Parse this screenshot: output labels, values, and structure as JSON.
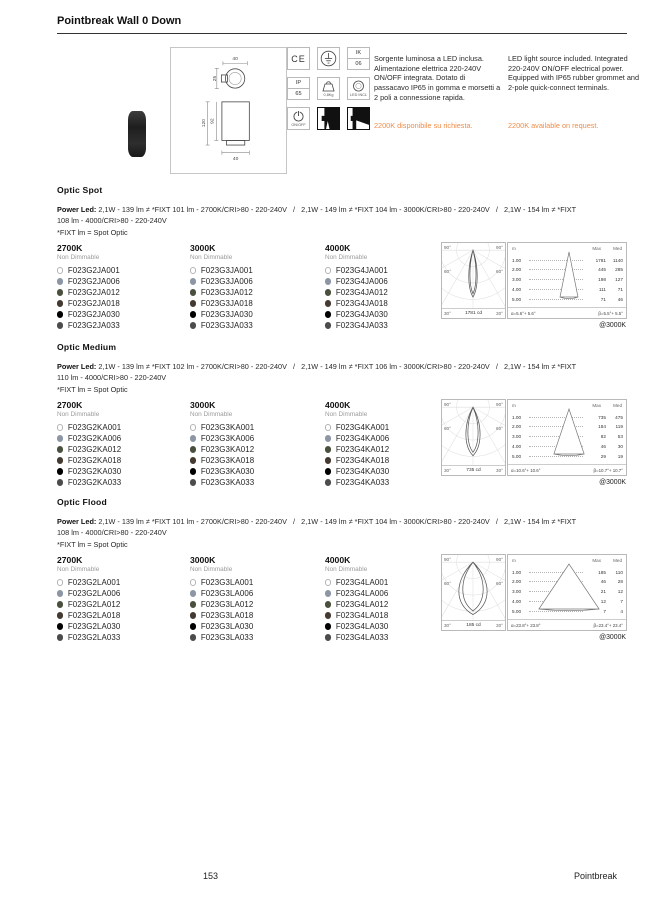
{
  "page": {
    "title": "Pointbreak Wall 0 Down",
    "page_number": "153",
    "brand": "Pointbreak"
  },
  "info": {
    "accent_color": "#ef8c48",
    "drawing": {
      "top_width": "40",
      "head_height": "25",
      "total_height": "120",
      "body_height": "92",
      "bottom_width": "40"
    },
    "icons": [
      {
        "id": "ce-mark",
        "text": "CE"
      },
      {
        "id": "class-1-earth"
      },
      {
        "id": "ik-rating",
        "top": "IK",
        "bottom": "06"
      },
      {
        "id": "ip-rating",
        "top": "IP",
        "bottom": "65"
      },
      {
        "id": "weight",
        "caption": "0,8Kg"
      },
      {
        "id": "led-included",
        "caption": "LED INCL"
      },
      {
        "id": "on-off",
        "caption": "ON/OFF"
      },
      {
        "id": "emission-down-spot"
      },
      {
        "id": "emission-down-flood"
      }
    ],
    "text_it": "Sorgente luminosa a LED inclusa. Alimentazione elettrica 220-240V ON/OFF integrata. Dotato di passacavo IP65 in gomma e morsetti a 2 poli a connessione rapida.",
    "note_it": "2200K disponibile su richiesta.",
    "text_en": "LED light source included. Integrated 220-240V ON/OFF electrical power. Equipped with IP65 rubber grommet and 2-pole quick-connect terminals.",
    "note_en": "2200K available on request."
  },
  "labels": {
    "m": "m",
    "max": "Max",
    "med": "Med",
    "deg90": "90°",
    "deg60": "60°",
    "deg30": "30°"
  },
  "finishes": [
    {
      "color": "#ffffff",
      "border": "#b3b3b3"
    },
    {
      "color": "#8d96a4"
    },
    {
      "color": "#49513e"
    },
    {
      "color": "#453a31"
    },
    {
      "color": "#000000"
    },
    {
      "color": "#4c4c4c"
    }
  ],
  "sections": [
    {
      "title": "Optic Spot",
      "power_led_label": "Power Led:",
      "spec": " 2,1W - 139 lm ≠ *FIXT 101 lm - 2700K/CRI>80 - 220-240V   /   2,1W - 149 lm ≠ *FIXT 104 lm - 3000K/CRI>80 - 220-240V   /   2,1W - 154 lm ≠ *FIXT 108 lm - 4000/CRI>80 - 220-240V",
      "spec_note": "*FIXT lm = Spot Optic",
      "columns": [
        {
          "temp": "2700K",
          "dimming": "Non Dimmable",
          "items": [
            "F023G2JA001",
            "F023G2JA006",
            "F023G2JA012",
            "F023G2JA018",
            "F023G2JA030",
            "F023G2JA033"
          ]
        },
        {
          "temp": "3000K",
          "dimming": "Non Dimmable",
          "items": [
            "F023G3JA001",
            "F023G3JA006",
            "F023G3JA012",
            "F023G3JA018",
            "F023G3JA030",
            "F023G3JA033"
          ]
        },
        {
          "temp": "4000K",
          "dimming": "Non Dimmable",
          "items": [
            "F023G4JA001",
            "F023G4JA006",
            "F023G4JA012",
            "F023G4JA018",
            "F023G4JA030",
            "F023G4JA033"
          ]
        }
      ],
      "photometry": {
        "polar_cd": "1781 cd",
        "beam": 5.5,
        "rows": [
          {
            "m": "1.00",
            "max": "1781",
            "med": "1140"
          },
          {
            "m": "2.00",
            "max": "445",
            "med": "285"
          },
          {
            "m": "3.00",
            "max": "198",
            "med": "127"
          },
          {
            "m": "4.00",
            "max": "111",
            "med": "71"
          },
          {
            "m": "5.00",
            "max": "71",
            "med": "46"
          }
        ],
        "alpha": "α=5.6°+ 5.6°",
        "beta": "β=5.5°+ 5.5°",
        "at_temp": "@3000K"
      }
    },
    {
      "title": "Optic Medium",
      "power_led_label": "Power Led:",
      "spec": " 2,1W - 139 lm ≠ *FIXT 102 lm - 2700K/CRI>80 - 220-240V   /   2,1W - 149 lm ≠ *FIXT 106 lm - 3000K/CRI>80 - 220-240V   /   2,1W - 154 lm ≠ *FIXT 110 lm - 4000/CRI>80 - 220-240V",
      "spec_note": "*FIXT lm = Spot Optic",
      "columns": [
        {
          "temp": "2700K",
          "dimming": "Non Dimmable",
          "items": [
            "F023G2KA001",
            "F023G2KA006",
            "F023G2KA012",
            "F023G2KA018",
            "F023G2KA030",
            "F023G2KA033"
          ]
        },
        {
          "temp": "3000K",
          "dimming": "Non Dimmable",
          "items": [
            "F023G3KA001",
            "F023G3KA006",
            "F023G3KA012",
            "F023G3KA018",
            "F023G3KA030",
            "F023G3KA033"
          ]
        },
        {
          "temp": "4000K",
          "dimming": "Non Dimmable",
          "items": [
            "F023G4KA001",
            "F023G4KA006",
            "F023G4KA012",
            "F023G4KA018",
            "F023G4KA030",
            "F023G4KA033"
          ]
        }
      ],
      "photometry": {
        "polar_cd": "735 cd",
        "beam": 10.7,
        "rows": [
          {
            "m": "1.00",
            "max": "735",
            "med": "475"
          },
          {
            "m": "2.00",
            "max": "184",
            "med": "119"
          },
          {
            "m": "3.00",
            "max": "82",
            "med": "53"
          },
          {
            "m": "4.00",
            "max": "46",
            "med": "30"
          },
          {
            "m": "5.00",
            "max": "29",
            "med": "19"
          }
        ],
        "alpha": "α=10.6°+ 10.6°",
        "beta": "β=10.7°+ 10.7°",
        "at_temp": "@3000K"
      }
    },
    {
      "title": "Optic Flood",
      "power_led_label": "Power Led:",
      "spec": " 2,1W - 139 lm ≠ *FIXT 101 lm - 2700K/CRI>80 - 220-240V   /   2,1W - 149 lm ≠ *FIXT 104 lm - 3000K/CRI>80 - 220-240V   /   2,1W - 154 lm ≠ *FIXT 108 lm - 4000/CRI>80 - 220-240V",
      "spec_note": "*FIXT lm = Spot Optic",
      "columns": [
        {
          "temp": "2700K",
          "dimming": "Non Dimmable",
          "items": [
            "F023G2LA001",
            "F023G2LA006",
            "F023G2LA012",
            "F023G2LA018",
            "F023G2LA030",
            "F023G2LA033"
          ]
        },
        {
          "temp": "3000K",
          "dimming": "Non Dimmable",
          "items": [
            "F023G3LA001",
            "F023G3LA006",
            "F023G3LA012",
            "F023G3LA018",
            "F023G3LA030",
            "F023G3LA033"
          ]
        },
        {
          "temp": "4000K",
          "dimming": "Non Dimmable",
          "items": [
            "F023G4LA001",
            "F023G4LA006",
            "F023G4LA012",
            "F023G4LA018",
            "F023G4LA030",
            "F023G4LA033"
          ]
        }
      ],
      "photometry": {
        "polar_cd": "185 cd",
        "beam": 23.4,
        "rows": [
          {
            "m": "1.00",
            "max": "185",
            "med": "110"
          },
          {
            "m": "2.00",
            "max": "46",
            "med": "28"
          },
          {
            "m": "3.00",
            "max": "21",
            "med": "12"
          },
          {
            "m": "4.00",
            "max": "12",
            "med": "7"
          },
          {
            "m": "5.00",
            "max": "7",
            "med": "4"
          }
        ],
        "alpha": "α=23.8°+ 23.8°",
        "beta": "β=23.4°+ 23.4°",
        "at_temp": "@3000K"
      }
    }
  ]
}
